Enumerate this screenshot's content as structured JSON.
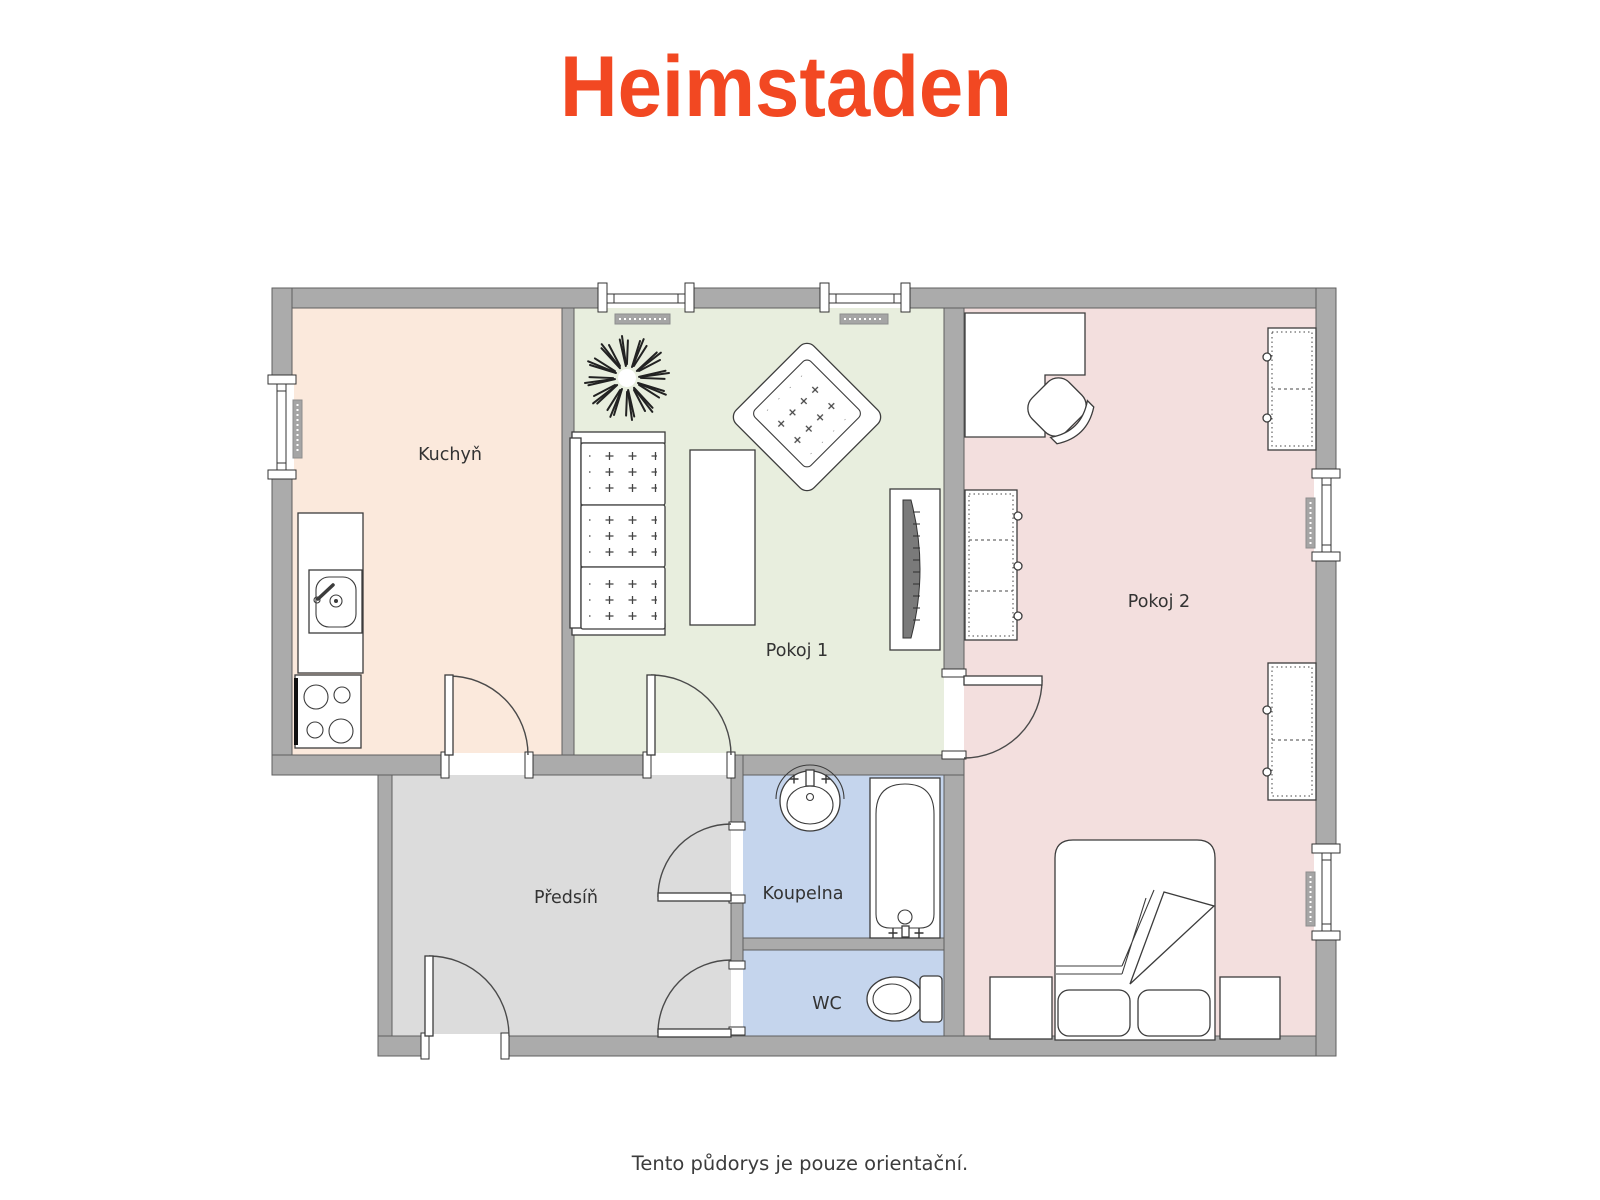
{
  "brand": {
    "logo_text": "Heimstaden",
    "logo_color": "#F24822"
  },
  "rooms": {
    "kuchyn": {
      "label": "Kuchyň"
    },
    "pokoj1": {
      "label": "Pokoj 1"
    },
    "pokoj2": {
      "label": "Pokoj 2"
    },
    "predsin": {
      "label": "Předsíň"
    },
    "koupelna": {
      "label": "Koupelna"
    },
    "wc": {
      "label": "WC"
    }
  },
  "palette": {
    "wall": "#ABABAB",
    "kuchyn_floor": "#FBE9DC",
    "pokoj1_floor": "#E8EEDE",
    "pokoj2_floor": "#F3DFDE",
    "predsin_floor": "#DCDCDC",
    "bath_floor": "#C5D5ED"
  },
  "footer": {
    "disclaimer": "Tento půdorys je pouze orientační."
  }
}
